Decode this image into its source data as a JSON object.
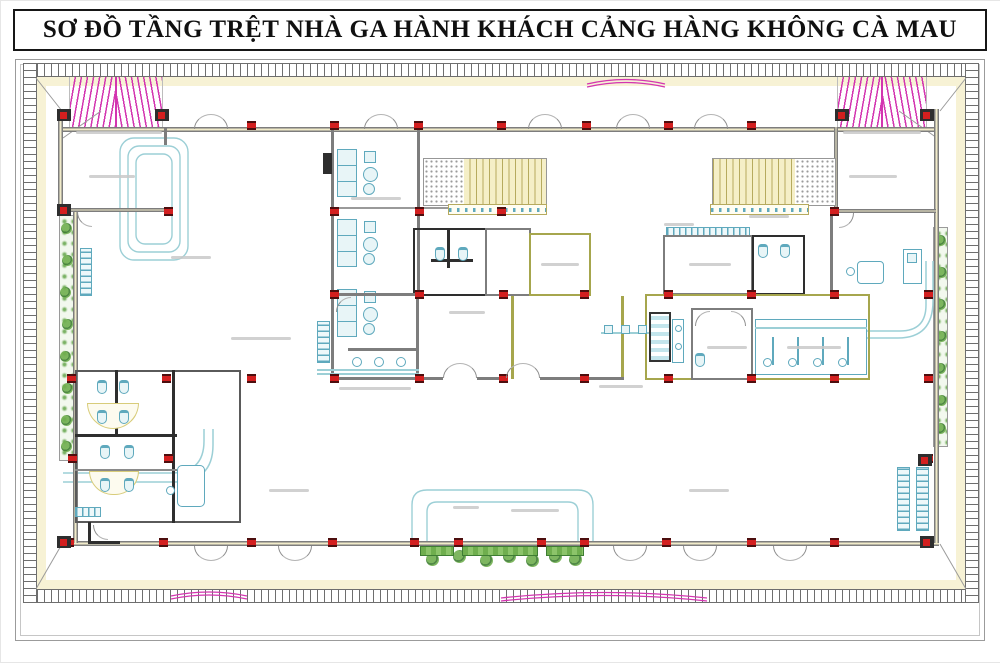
{
  "title": "SƠ ĐỒ TẦNG TRỆT NHÀ GA HÀNH KHÁCH CẢNG HÀNG KHÔNG CÀ MAU",
  "colors": {
    "wall": "#7d7d7d",
    "wall_dark": "#2e2e2e",
    "wall_olive": "#a6a64d",
    "glazing": "#f1ebc9",
    "column_red": "#d31f1f",
    "column_cap": "#4d0e0e",
    "cyan": "#5fa9bd",
    "cyan_pale": "#9ccfd6",
    "cyan_fill": "#e8f5f7",
    "magenta": "#d335b0",
    "band_yellow": "#f7f2d5",
    "stair_fill": "#f5efc7",
    "stair_line": "#b6aa5e",
    "stipple": "#9b9b9b",
    "green": "#6fae4e",
    "green_dark": "#3e7d33",
    "label": "#c9c9c9",
    "frame": "#9b9b9b",
    "tick": "#6e6e6e",
    "title_color": "#101010"
  },
  "plan": {
    "column_rows": [
      {
        "y": 124,
        "xs": [
          250,
          333,
          417,
          500,
          585,
          667,
          750
        ]
      },
      {
        "y": 210,
        "xs": [
          63,
          167,
          333,
          418,
          500,
          833
        ]
      },
      {
        "y": 293,
        "xs": [
          333,
          418,
          502,
          583,
          667,
          750,
          833,
          927
        ]
      },
      {
        "y": 377,
        "xs": [
          70,
          165,
          250,
          333,
          418,
          502,
          583,
          667,
          750,
          833,
          927
        ]
      },
      {
        "y": 457,
        "xs": [
          71,
          167,
          927
        ]
      },
      {
        "y": 541,
        "xs": [
          68,
          162,
          250,
          331,
          413,
          457,
          540,
          583,
          665,
          750,
          833,
          927
        ]
      }
    ],
    "corner_blocks": [
      [
        56,
        108
      ],
      [
        154,
        108
      ],
      [
        834,
        108
      ],
      [
        919,
        108
      ],
      [
        56,
        535
      ],
      [
        919,
        535
      ],
      [
        917,
        453
      ],
      [
        56,
        203
      ]
    ],
    "double_doors": [
      {
        "y": 128,
        "dir": "up",
        "xs": [
          193,
          363,
          527,
          615,
          693
        ]
      },
      {
        "y": 543,
        "dir": "down",
        "xs": [
          193,
          277,
          612,
          682,
          772
        ]
      },
      {
        "y": 377,
        "dir": "up",
        "xs": [
          442,
          505
        ]
      }
    ],
    "wc_fixtures": [
      [
        96,
        379
      ],
      [
        118,
        379
      ],
      [
        96,
        409
      ],
      [
        118,
        409
      ],
      [
        99,
        444
      ],
      [
        123,
        444
      ],
      [
        99,
        477
      ],
      [
        123,
        477
      ],
      [
        434,
        246
      ],
      [
        457,
        246
      ],
      [
        757,
        243
      ],
      [
        779,
        243
      ],
      [
        694,
        352
      ]
    ],
    "bushes": {
      "left": [
        [
          60,
          222
        ],
        [
          61,
          254
        ],
        [
          59,
          286
        ],
        [
          61,
          318
        ],
        [
          59,
          350
        ],
        [
          61,
          382
        ],
        [
          60,
          414
        ],
        [
          60,
          440
        ]
      ],
      "right": [
        [
          934,
          234
        ],
        [
          935,
          266
        ],
        [
          934,
          298
        ],
        [
          935,
          330
        ],
        [
          934,
          362
        ],
        [
          935,
          394
        ],
        [
          934,
          422
        ]
      ],
      "hedge": [
        [
          425,
          552
        ],
        [
          452,
          549
        ],
        [
          479,
          553
        ],
        [
          502,
          549
        ],
        [
          525,
          553
        ],
        [
          548,
          549
        ],
        [
          568,
          552
        ]
      ]
    },
    "bush_size": {
      "left": 11,
      "right": 11,
      "hedge": 13
    },
    "label_marks": [
      [
        88,
        174,
        46
      ],
      [
        848,
        174,
        48
      ],
      [
        350,
        196,
        50
      ],
      [
        230,
        336,
        60
      ],
      [
        338,
        386,
        72
      ],
      [
        448,
        310,
        36
      ],
      [
        540,
        262,
        38
      ],
      [
        688,
        262,
        42
      ],
      [
        706,
        345,
        40
      ],
      [
        786,
        345,
        54
      ],
      [
        598,
        384,
        44
      ],
      [
        748,
        214,
        40
      ],
      [
        663,
        222,
        30
      ],
      [
        268,
        488,
        40
      ],
      [
        688,
        488,
        40
      ],
      [
        452,
        505,
        26
      ],
      [
        510,
        508,
        48
      ],
      [
        75,
        130,
        86
      ],
      [
        842,
        130,
        78
      ],
      [
        170,
        255,
        40
      ]
    ]
  }
}
